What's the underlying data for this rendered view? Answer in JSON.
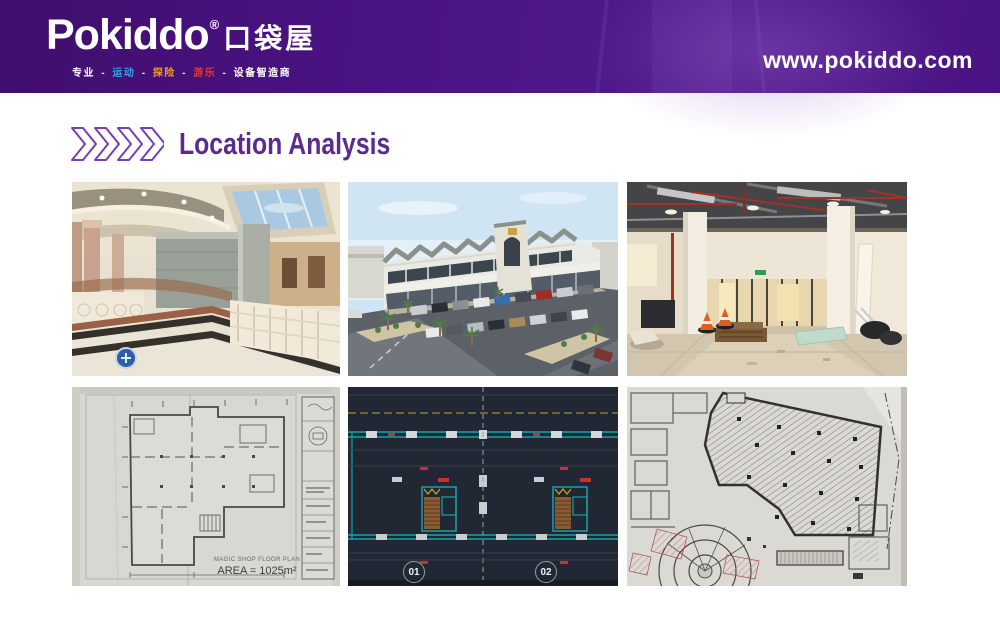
{
  "header": {
    "brand": "Pokiddo",
    "registered_mark": "®",
    "brand_cjk": "口袋屋",
    "tagline": [
      {
        "text": "专业"
      },
      {
        "text": "-"
      },
      {
        "text": "运动"
      },
      {
        "text": "-"
      },
      {
        "text": "探险"
      },
      {
        "text": "-"
      },
      {
        "text": "游乐"
      },
      {
        "text": "-"
      },
      {
        "text": "设备智造商"
      }
    ],
    "website": "www.pokiddo.com"
  },
  "page": {
    "title": "Location Analysis"
  },
  "colors": {
    "header_purple": "#4a1383",
    "title_purple": "#5c2b8f",
    "tagline_blue": "#35a3e6",
    "tagline_orange": "#f59a1d",
    "tagline_red": "#e8362c",
    "cad_background": "#212834",
    "cad_cyan": "#18a2aa"
  },
  "gallery": {
    "floor_plan": {
      "caption_title": "MAGIC SHOP FLOOR PLAN",
      "caption_area": "AREA = 1025m²"
    },
    "cad": {
      "bubble_1": "01",
      "bubble_2": "02"
    },
    "photo_names": [
      "mall-interior-photo",
      "building-exterior-render",
      "construction-interior-photo",
      "floor-plan-photo",
      "cad-floor-plan",
      "hatched-floor-plan"
    ]
  }
}
